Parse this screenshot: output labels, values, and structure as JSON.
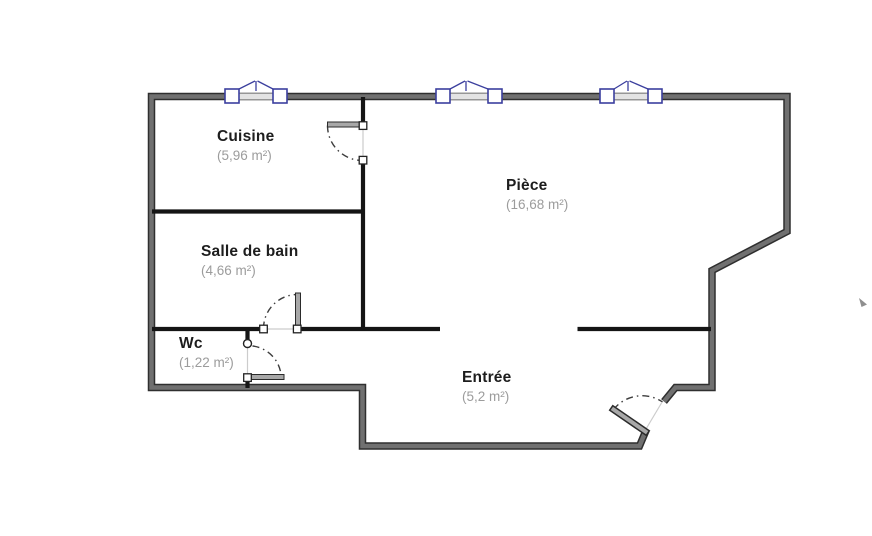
{
  "plan": {
    "rooms": [
      {
        "id": "cuisine",
        "name": "Cuisine",
        "area": "(5,96 m²)"
      },
      {
        "id": "piece",
        "name": "Pièce",
        "area": "(16,68 m²)"
      },
      {
        "id": "salle-de-bain",
        "name": "Salle de bain",
        "area": "(4,66 m²)"
      },
      {
        "id": "wc",
        "name": "Wc",
        "area": "(1,22 m²)"
      },
      {
        "id": "entree",
        "name": "Entrée",
        "area": "(5,2 m²)"
      }
    ],
    "window_count": 3,
    "door_count": 4,
    "colors": {
      "background": "#ffffff",
      "outer_wall_edge": "#2f2f2f",
      "outer_wall_fill": "#707070",
      "interior_wall": "#151515",
      "window_accent": "#3b3f9e",
      "window_glass": "#e3e3e3",
      "door_leaf_fill": "#a8a8a8",
      "door_leaf_edge": "#2b2b2b",
      "door_arc": "#3d3d3d",
      "jamb_line": "#cccccc",
      "room_name_color": "#1d1d1d",
      "room_area_color": "#9c9c9c"
    }
  }
}
